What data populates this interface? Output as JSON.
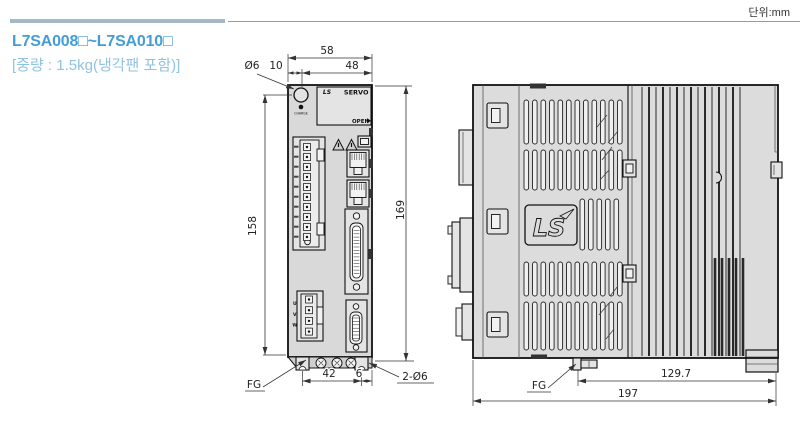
{
  "unit_note": "단위:mm",
  "title": {
    "model_range": "L7SA008□~L7SA010□",
    "weight": "[중량 : 1.5kg(냉각팬 포함)]"
  },
  "front_view": {
    "brand": "LS",
    "servo": "SERVO",
    "open_label": "OPEN",
    "charge_label": "CHARGE",
    "uvw": [
      "U",
      "V",
      "W"
    ],
    "dims": {
      "overall_width": "58",
      "hole_span": "48",
      "hole_offset": "10",
      "hole_dia": "Ø6",
      "body_height": "158",
      "overall_height": "169",
      "bottom_hole_span": "42",
      "bottom_hole_edge": "6",
      "bottom_holes": "2-Ø6",
      "fg": "FG"
    }
  },
  "side_view": {
    "brand": "LS",
    "dims": {
      "fin_depth": "129.7",
      "overall_depth": "197",
      "fg": "FG"
    }
  },
  "colors": {
    "accent_bar": "#a3b9c6",
    "title_blue": "#459dd6",
    "subtitle_blue": "#8fc3e2"
  }
}
